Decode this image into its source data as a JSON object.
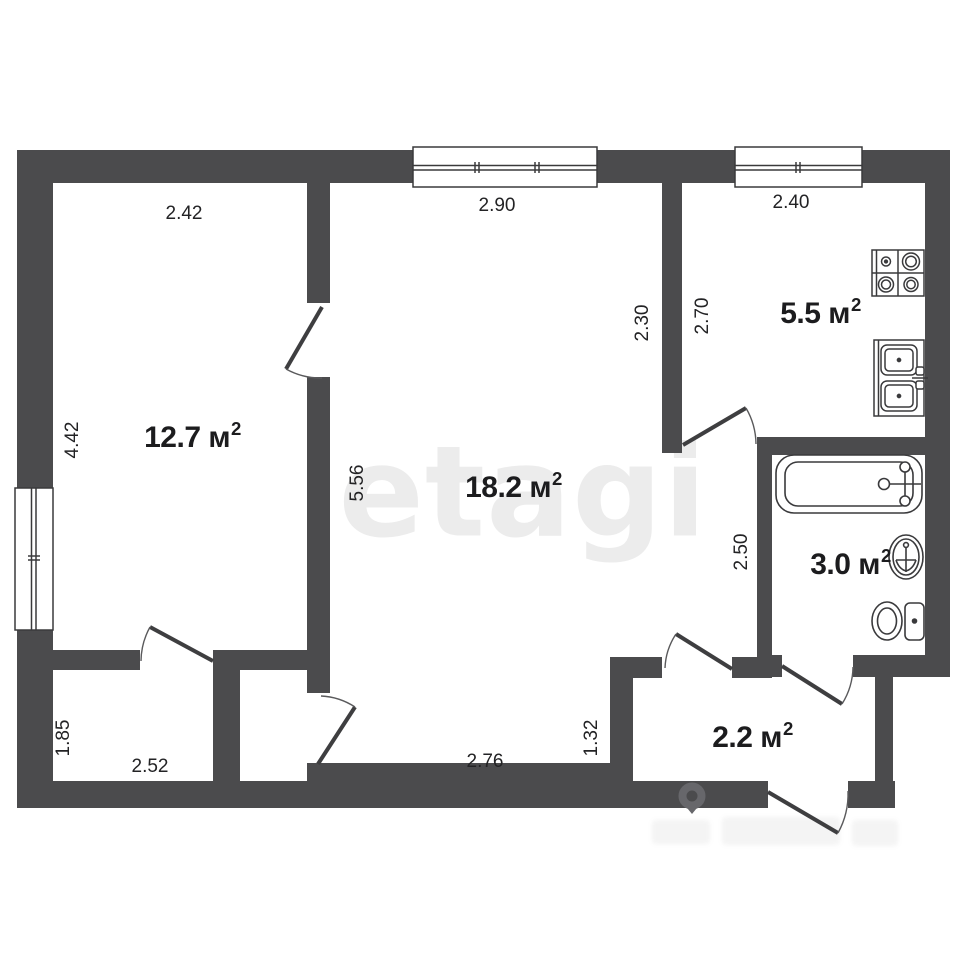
{
  "watermark": {
    "text": "etagi"
  },
  "colors": {
    "wall": "#4b4b4d",
    "line": "#3a3a3c",
    "label": "#1c1c1e",
    "watermark": "#ececec",
    "background": "#ffffff"
  },
  "rooms": [
    {
      "id": "bedroom",
      "area": "12.7 м",
      "sup": "2"
    },
    {
      "id": "living",
      "area": "18.2 м",
      "sup": "2"
    },
    {
      "id": "kitchen",
      "area": "5.5 м",
      "sup": "2"
    },
    {
      "id": "bathroom",
      "area": "3.0 м",
      "sup": "2"
    },
    {
      "id": "hallway",
      "area": "2.2 м",
      "sup": "2"
    }
  ],
  "dimensions": [
    {
      "id": "bedroom-top",
      "value": "2.42",
      "orientation": "horizontal"
    },
    {
      "id": "living-top",
      "value": "2.90",
      "orientation": "horizontal"
    },
    {
      "id": "kitchen-top",
      "value": "2.40",
      "orientation": "horizontal"
    },
    {
      "id": "bedroom-left",
      "value": "4.42",
      "orientation": "vertical"
    },
    {
      "id": "living-left",
      "value": "5.56",
      "orientation": "vertical"
    },
    {
      "id": "living-kitchen-wall",
      "value": "2.30",
      "orientation": "vertical"
    },
    {
      "id": "kitchen-left",
      "value": "2.70",
      "orientation": "vertical"
    },
    {
      "id": "corridor",
      "value": "2.50",
      "orientation": "vertical"
    },
    {
      "id": "closet-left",
      "value": "1.85",
      "orientation": "vertical"
    },
    {
      "id": "closet-bottom",
      "value": "2.52",
      "orientation": "horizontal"
    },
    {
      "id": "living-bottom",
      "value": "2.76",
      "orientation": "horizontal"
    },
    {
      "id": "hallway-left",
      "value": "1.32",
      "orientation": "vertical"
    }
  ],
  "fixtures": [
    "stove",
    "kitchen-sink",
    "bathtub",
    "washbasin",
    "toilet"
  ],
  "openings": {
    "windows": [
      "living-room-window",
      "kitchen-window",
      "bedroom-window"
    ],
    "doors": [
      "bedroom-door",
      "closet-door",
      "storage-door",
      "kitchen-door",
      "hallway-door",
      "bathroom-door",
      "entrance-door"
    ]
  }
}
